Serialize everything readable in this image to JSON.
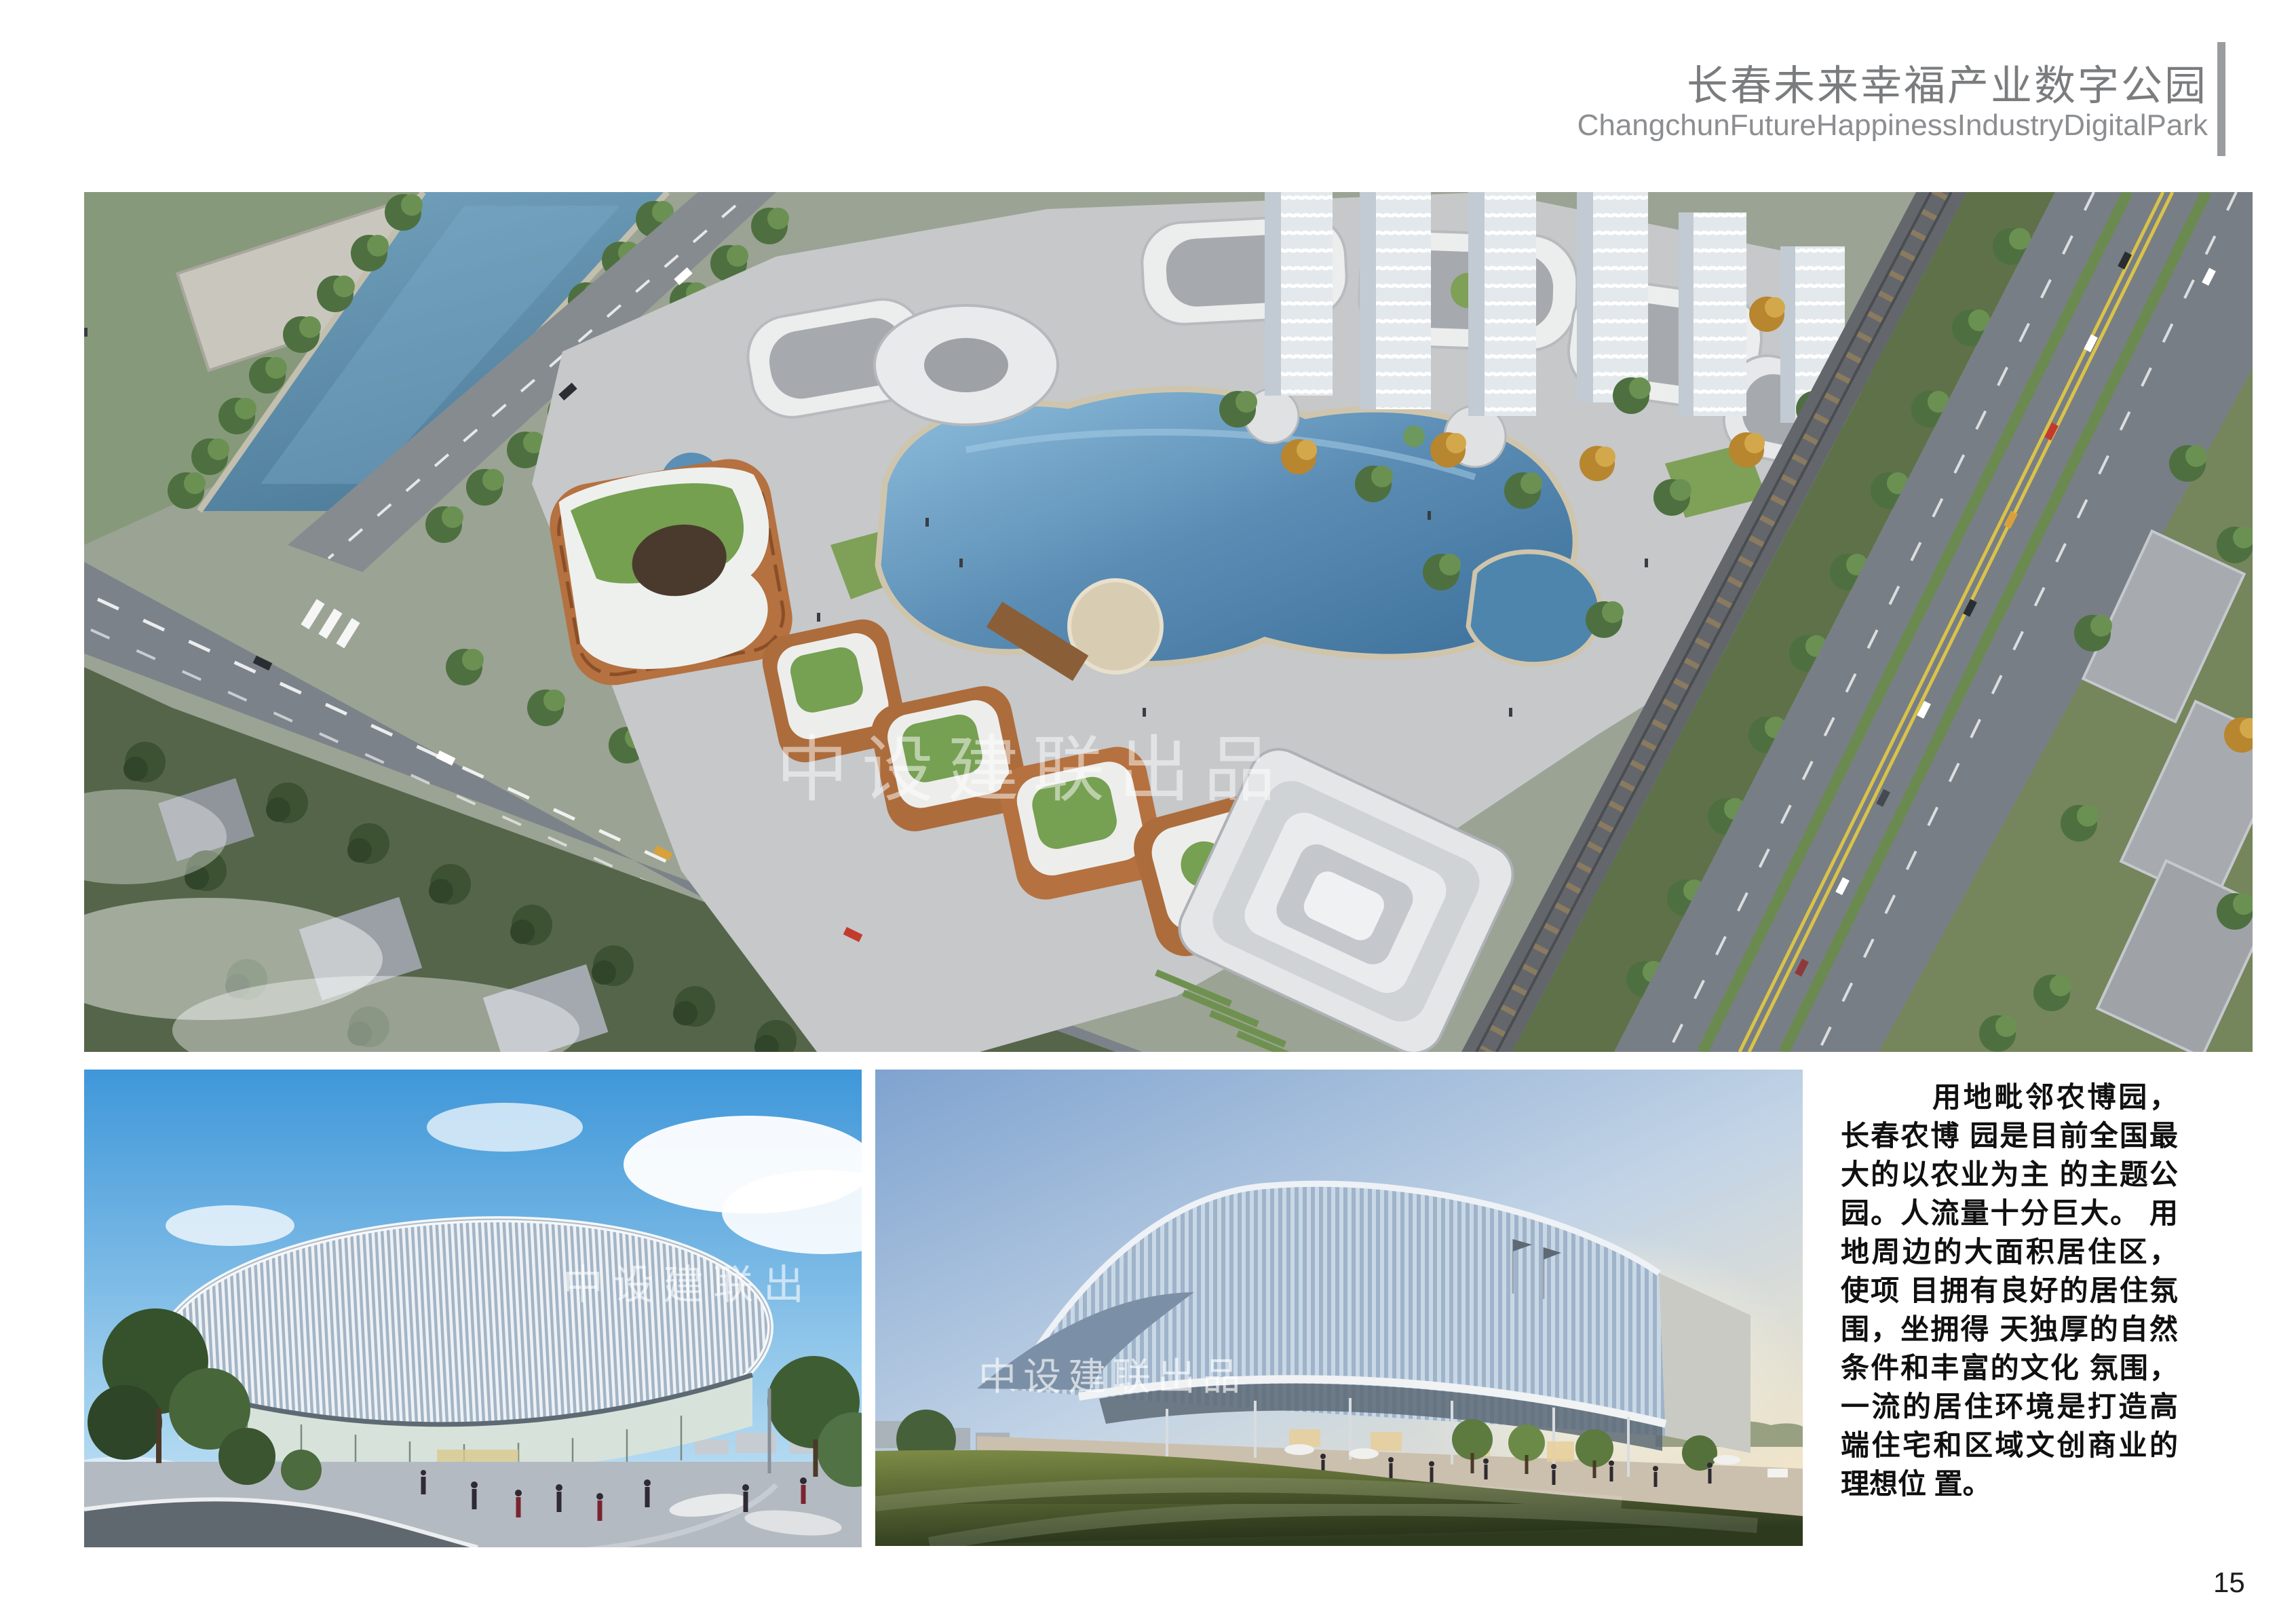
{
  "header": {
    "title": "长春未来幸福产业数字公园",
    "subtitle": "ChangchunFutureHappinessIndustryDigitalPark"
  },
  "watermarks": {
    "full": "中设建联出品",
    "partial": "中设建联出"
  },
  "description": {
    "lines": [
      "用地毗邻农博园，",
      "长春农博 园是目前全国最",
      "大的以农业为主 的主题公",
      "园。人流量十分巨大。 用",
      "地周边的大面积居住区，",
      "使项 目拥有良好的居住氛",
      "围，坐拥得 天独厚的自然",
      "条件和丰富的文化 氛围，",
      "一流的居住环境是打造高",
      "端住宅和区域文创商业的",
      "理想位 置。"
    ]
  },
  "page_number": "15",
  "colors": {
    "header_text": "#7a7c7e",
    "header_subtext": "#8c8e91",
    "header_bar": "#9a9ca0",
    "body_text": "#101010",
    "watermark": "#ffffff",
    "lake": "#4e85ac",
    "river": "#5d8fae",
    "plaza": "#c6c8ca",
    "road": "#7c8289"
  }
}
